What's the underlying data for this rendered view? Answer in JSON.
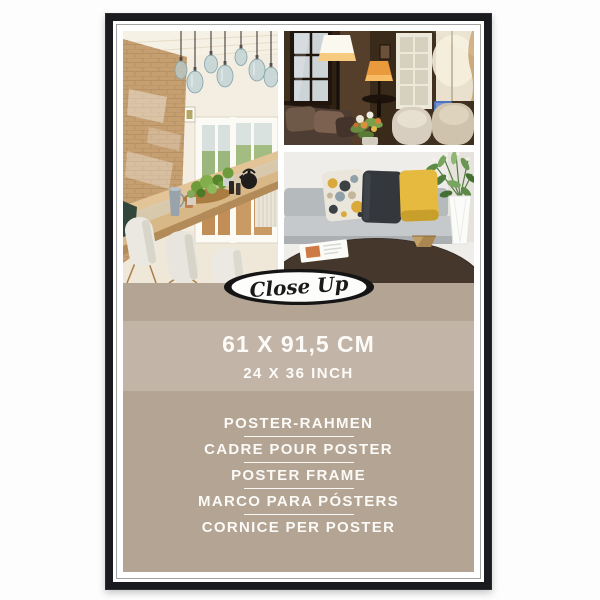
{
  "product": {
    "brand": "Close Up",
    "size_cm": "61 X 91,5 CM",
    "size_inch": "24 X 36 INCH",
    "product_names": [
      "POSTER-RAHMEN",
      "CADRE POUR POSTER",
      "POSTER FRAME",
      "MARCO PARA PÓSTERS",
      "CORNICE PER POSTER"
    ]
  },
  "photos": {
    "left": "dining room with brick wall, glass pendant lights, long wooden table and white shell chairs",
    "top_right": "living room with white floor lamp, orange table lamp and beige armchairs",
    "bottom_right": "grey sofa with dotted, charcoal and yellow cushions, plant in white vase, dark coffee table"
  },
  "colors": {
    "frame_black": "#1a1b1e",
    "mat_white": "#ffffff",
    "insert_taupe": "#b3a494",
    "insert_taupe_light": "#c2b4a6",
    "text_white": "#fbfaf7"
  }
}
